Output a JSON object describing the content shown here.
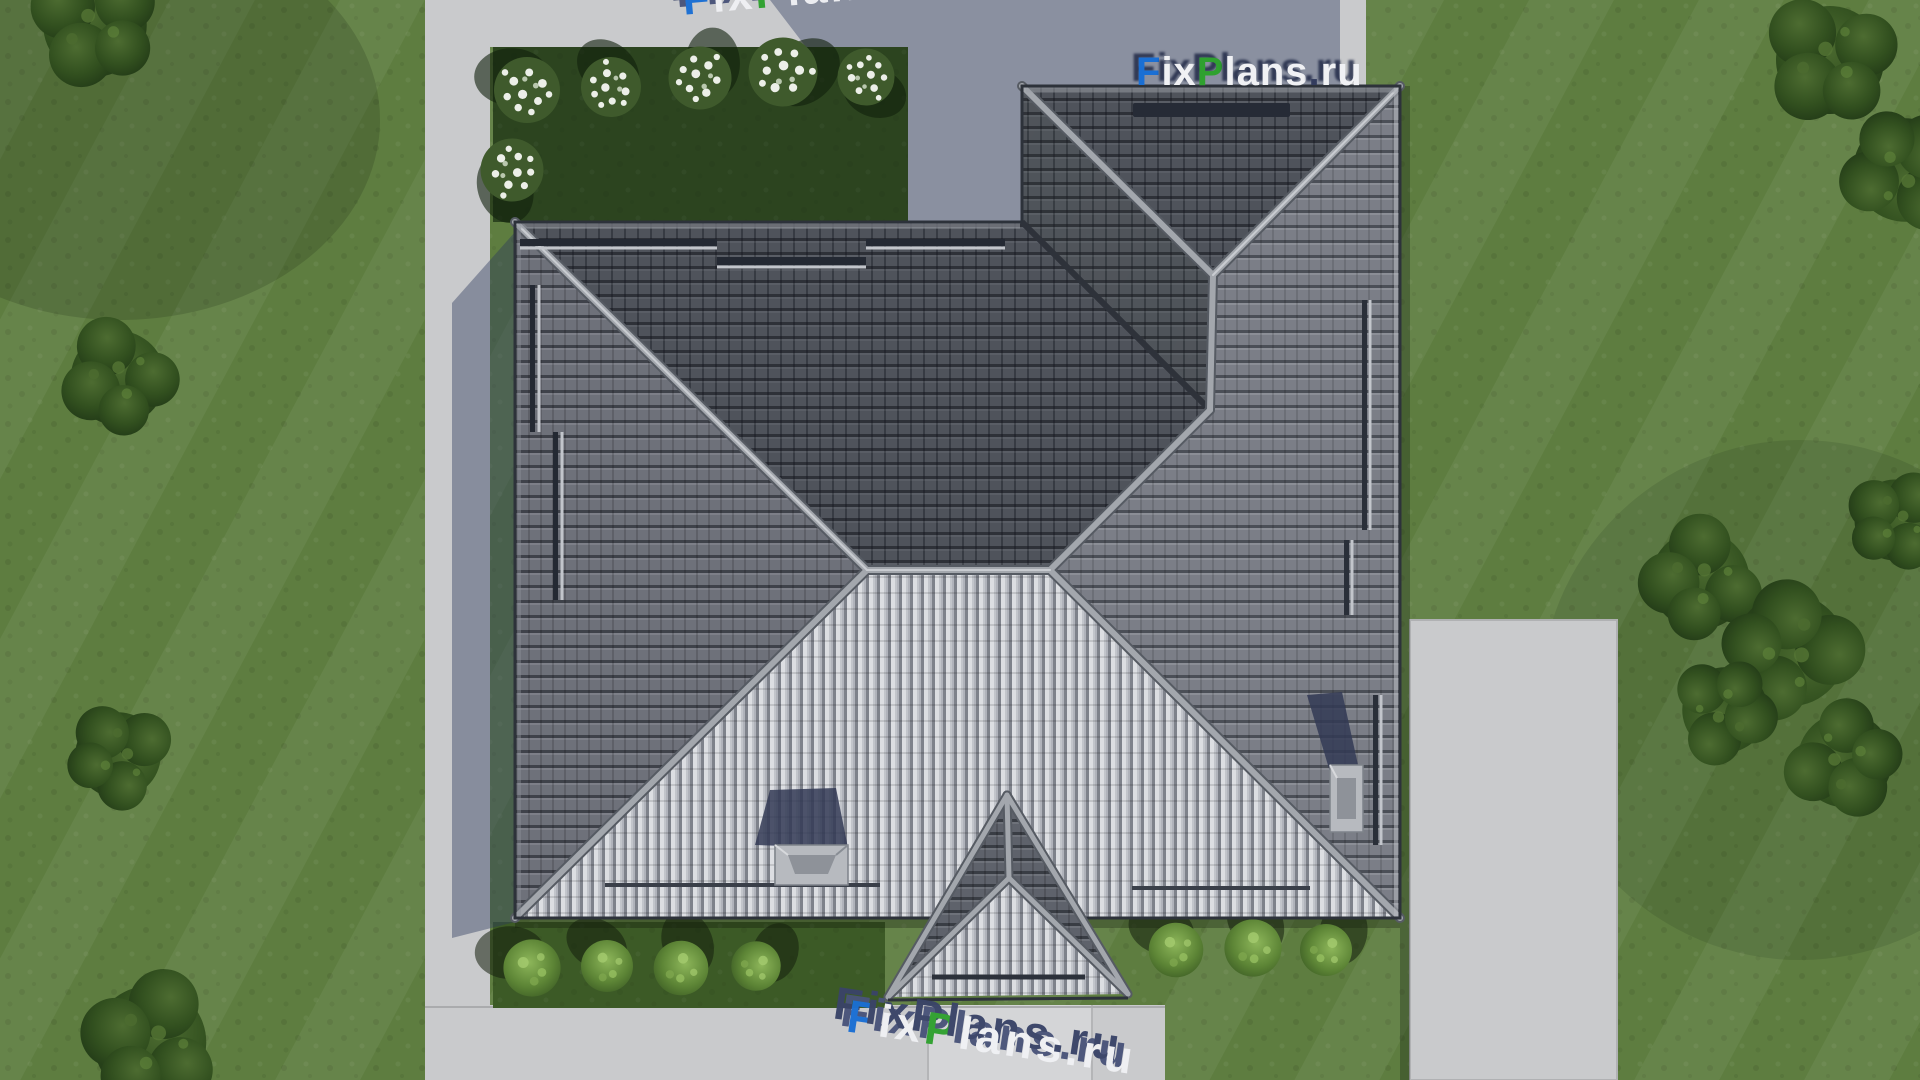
{
  "watermark": {
    "full": "FixPlans.ru",
    "part_f": "F",
    "part_ix": "ix",
    "part_p": "P",
    "part_lans": "lans",
    "part_dot": ".",
    "part_ru": "ru"
  },
  "palette": {
    "grass": "#5e7d40",
    "grass_dark": "#3d5527",
    "garden_dark": "#2c441f",
    "bed_green": "#3c5a26",
    "pavement": "#c9cacc",
    "pavement_bright": "#d4d5d7",
    "shadow_blue": "#2e3a5e",
    "roof_north": "#4f535b",
    "roof_west": "#6e717a",
    "roof_east": "#7b7e87",
    "roof_south": "#b0b3bb",
    "roof_porch": "#5e626b",
    "ridge": "#a3a7ad",
    "valley": "#2e323a",
    "tree": "#2f4a24",
    "bush": "#6f9b46",
    "flower": "#ecefe8",
    "chimney": "#b7babf",
    "wm_blue": "#1a6fd4",
    "wm_green": "#2fa12f",
    "wm_white": "#f0f1f4",
    "wm_shadow": "#3a4468"
  }
}
